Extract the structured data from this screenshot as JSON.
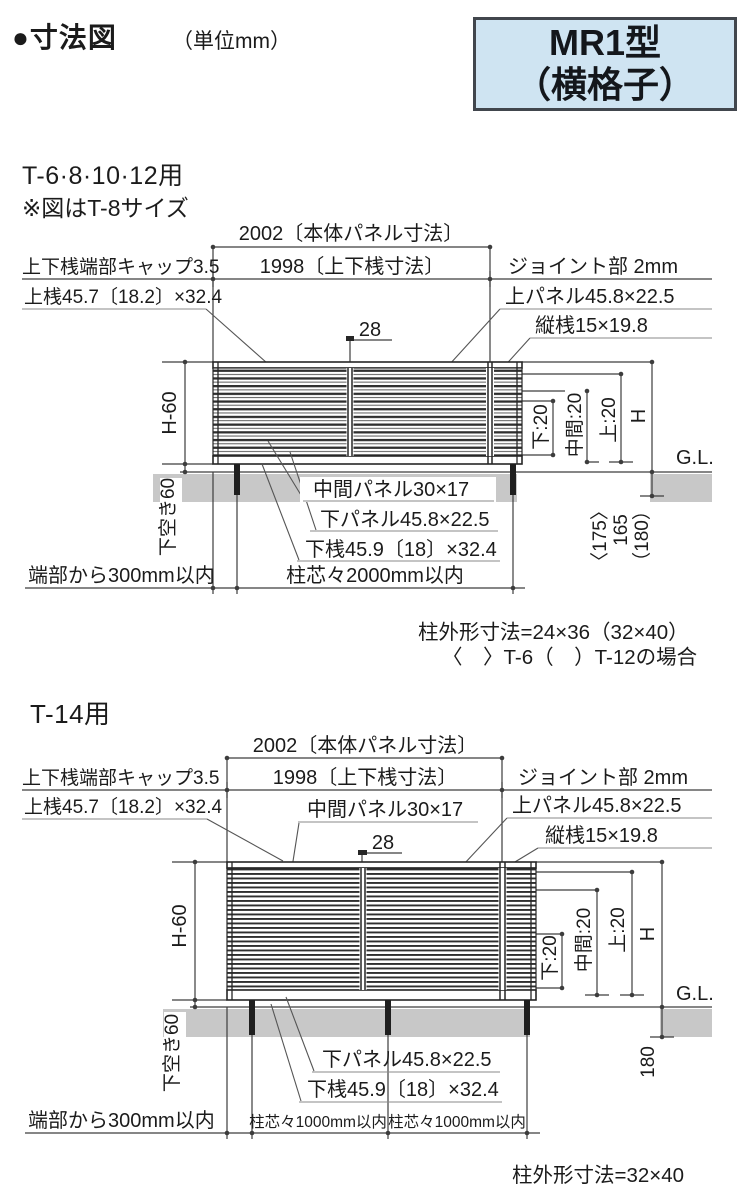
{
  "header": {
    "title": "●寸法図",
    "unit": "（単位mm）",
    "model_line1": "MR1型",
    "model_line2": "（横格子）"
  },
  "colors": {
    "model_bg": "#cfe4f2",
    "model_border": "#41464d",
    "ground": "#c8c8c8"
  },
  "d1": {
    "title": "T-6·8·10·12用",
    "subtitle": "※図はT-8サイズ",
    "panel_width": "2002〔本体パネル寸法〕",
    "rail_width": "1998〔上下桟寸法〕",
    "end_cap": "上下桟端部キャップ3.5",
    "joint": "ジョイント部 2mm",
    "top_rail": "上桟45.7〔18.2〕×32.4",
    "top_panel": "上パネル45.8×22.5",
    "vertical_rail": "縦桟15×19.8",
    "joint_width": "28",
    "panel_height": "H-60",
    "bottom_gap": "下空き60",
    "pitch_bottom": "下:20",
    "pitch_middle": "中間:20",
    "pitch_top": "上:20",
    "total_height": "H",
    "ground_level": "G.L.",
    "embed_t6": "〈175〉",
    "embed": "165",
    "embed_t12": "（180）",
    "mid_panel": "中間パネル30×17",
    "bottom_panel": "下パネル45.8×22.5",
    "bottom_rail": "下桟45.9〔18〕×32.4",
    "edge_offset": "端部から300mm以内",
    "post_pitch": "柱芯々2000mm以内",
    "note_line1": "柱外形寸法=24×36（32×40）",
    "note_line2": "〈　〉T-6（　）T-12の場合"
  },
  "d2": {
    "title": "T-14用",
    "panel_width": "2002〔本体パネル寸法〕",
    "rail_width": "1998〔上下桟寸法〕",
    "end_cap": "上下桟端部キャップ3.5",
    "joint": "ジョイント部 2mm",
    "top_rail": "上桟45.7〔18.2〕×32.4",
    "top_panel": "上パネル45.8×22.5",
    "vertical_rail": "縦桟15×19.8",
    "mid_panel": "中間パネル30×17",
    "joint_width": "28",
    "panel_height": "H-60",
    "bottom_gap": "下空き60",
    "pitch_bottom": "下:20",
    "pitch_middle": "中間:20",
    "pitch_top": "上:20",
    "total_height": "H",
    "ground_level": "G.L.",
    "embed": "180",
    "bottom_panel": "下パネル45.8×22.5",
    "bottom_rail": "下桟45.9〔18〕×32.4",
    "edge_offset": "端部から300mm以内",
    "post_pitch1": "柱芯々1000mm以内",
    "post_pitch2": "柱芯々1000mm以内",
    "note_line1": "柱外形寸法=32×40"
  }
}
